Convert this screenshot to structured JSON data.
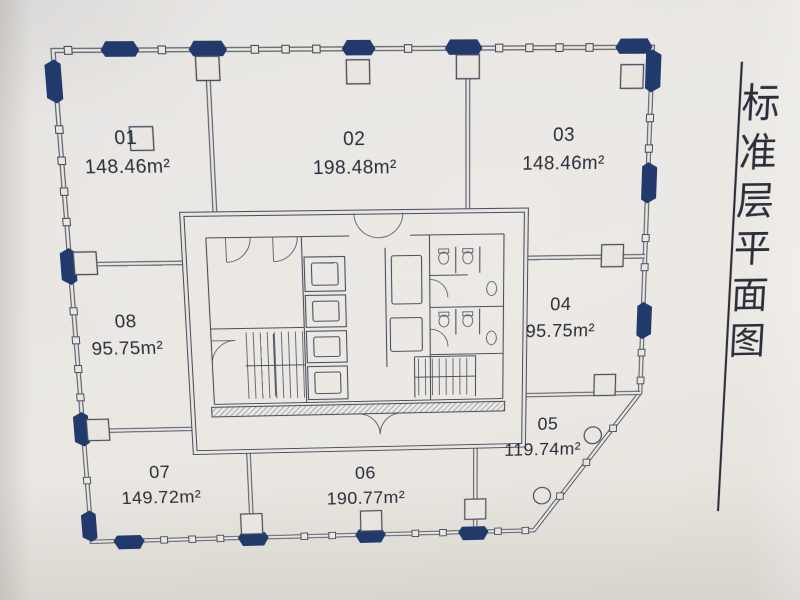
{
  "title": {
    "text": "标准层平面图",
    "chars": [
      "标",
      "准",
      "层",
      "平",
      "面",
      "图"
    ]
  },
  "units": [
    {
      "id": "01",
      "area": "148.46m²"
    },
    {
      "id": "02",
      "area": "198.48m²"
    },
    {
      "id": "03",
      "area": "148.46m²"
    },
    {
      "id": "04",
      "area": "95.75m²"
    },
    {
      "id": "05",
      "area": "119.74m²"
    },
    {
      "id": "06",
      "area": "190.77m²"
    },
    {
      "id": "07",
      "area": "149.72m²"
    },
    {
      "id": "08",
      "area": "95.75m²"
    }
  ],
  "colors": {
    "paper": "#e9e6e2",
    "line": "#4a4f5e",
    "navy": "#21396b",
    "text": "#2b2e39",
    "title": "#2c2f3b"
  }
}
